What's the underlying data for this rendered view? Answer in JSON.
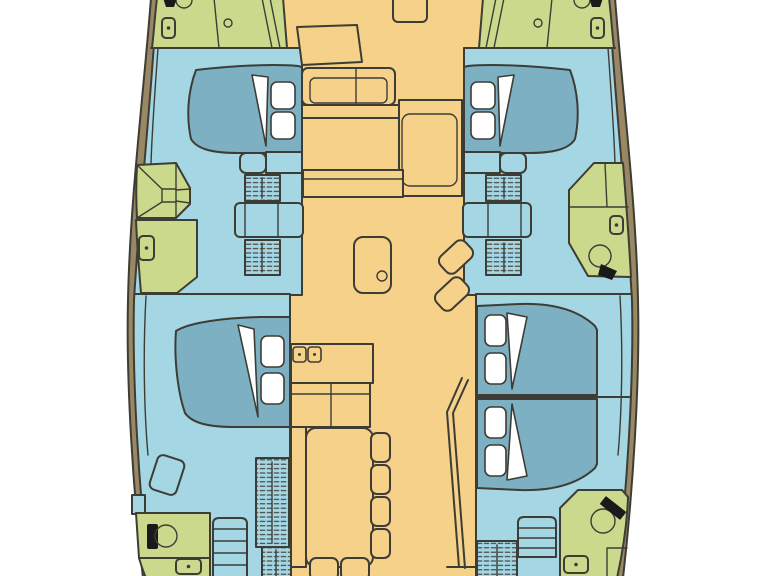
{
  "diagram": {
    "type": "catamaran-floor-plan",
    "view": "top-down deck layout, bow at top, no text labels",
    "hulls": 2,
    "cabin_count": 4,
    "berth_count": 5
  },
  "colors": {
    "background": "#ffffff",
    "deck": "#f5d189",
    "cabin": "#a4d6e4",
    "bed": "#7eb0c4",
    "wet": "#cbd98d",
    "line": "#3d3d35",
    "band": "#998863",
    "white": "#ffffff",
    "black": "#1a1a1a"
  },
  "areas": {
    "port_hull": [
      "bow-deck",
      "forward-cabin",
      "shower",
      "mid-head",
      "aft-cabin",
      "aft-head",
      "companionway-stairs"
    ],
    "starboard_hull": [
      "bow-deck",
      "forward-cabin",
      "mid-head-with-toilet",
      "aft-cabin-1",
      "aft-cabin-2",
      "aft-head-with-sink",
      "companionway-stairs"
    ],
    "salon": [
      "forward-cockpit-bench",
      "galley-counters",
      "stove",
      "sink-table",
      "nav-seats",
      "dining-table",
      "chairs",
      "aft-partition"
    ]
  },
  "features": {
    "beds": 5,
    "pillows": 10,
    "blanket_folds": 5,
    "toilets": 2,
    "sinks": 1,
    "showers": 1,
    "stair_flights": 7,
    "deck_hatches": 7,
    "dining_seats": 6,
    "stove_burners": 2
  }
}
